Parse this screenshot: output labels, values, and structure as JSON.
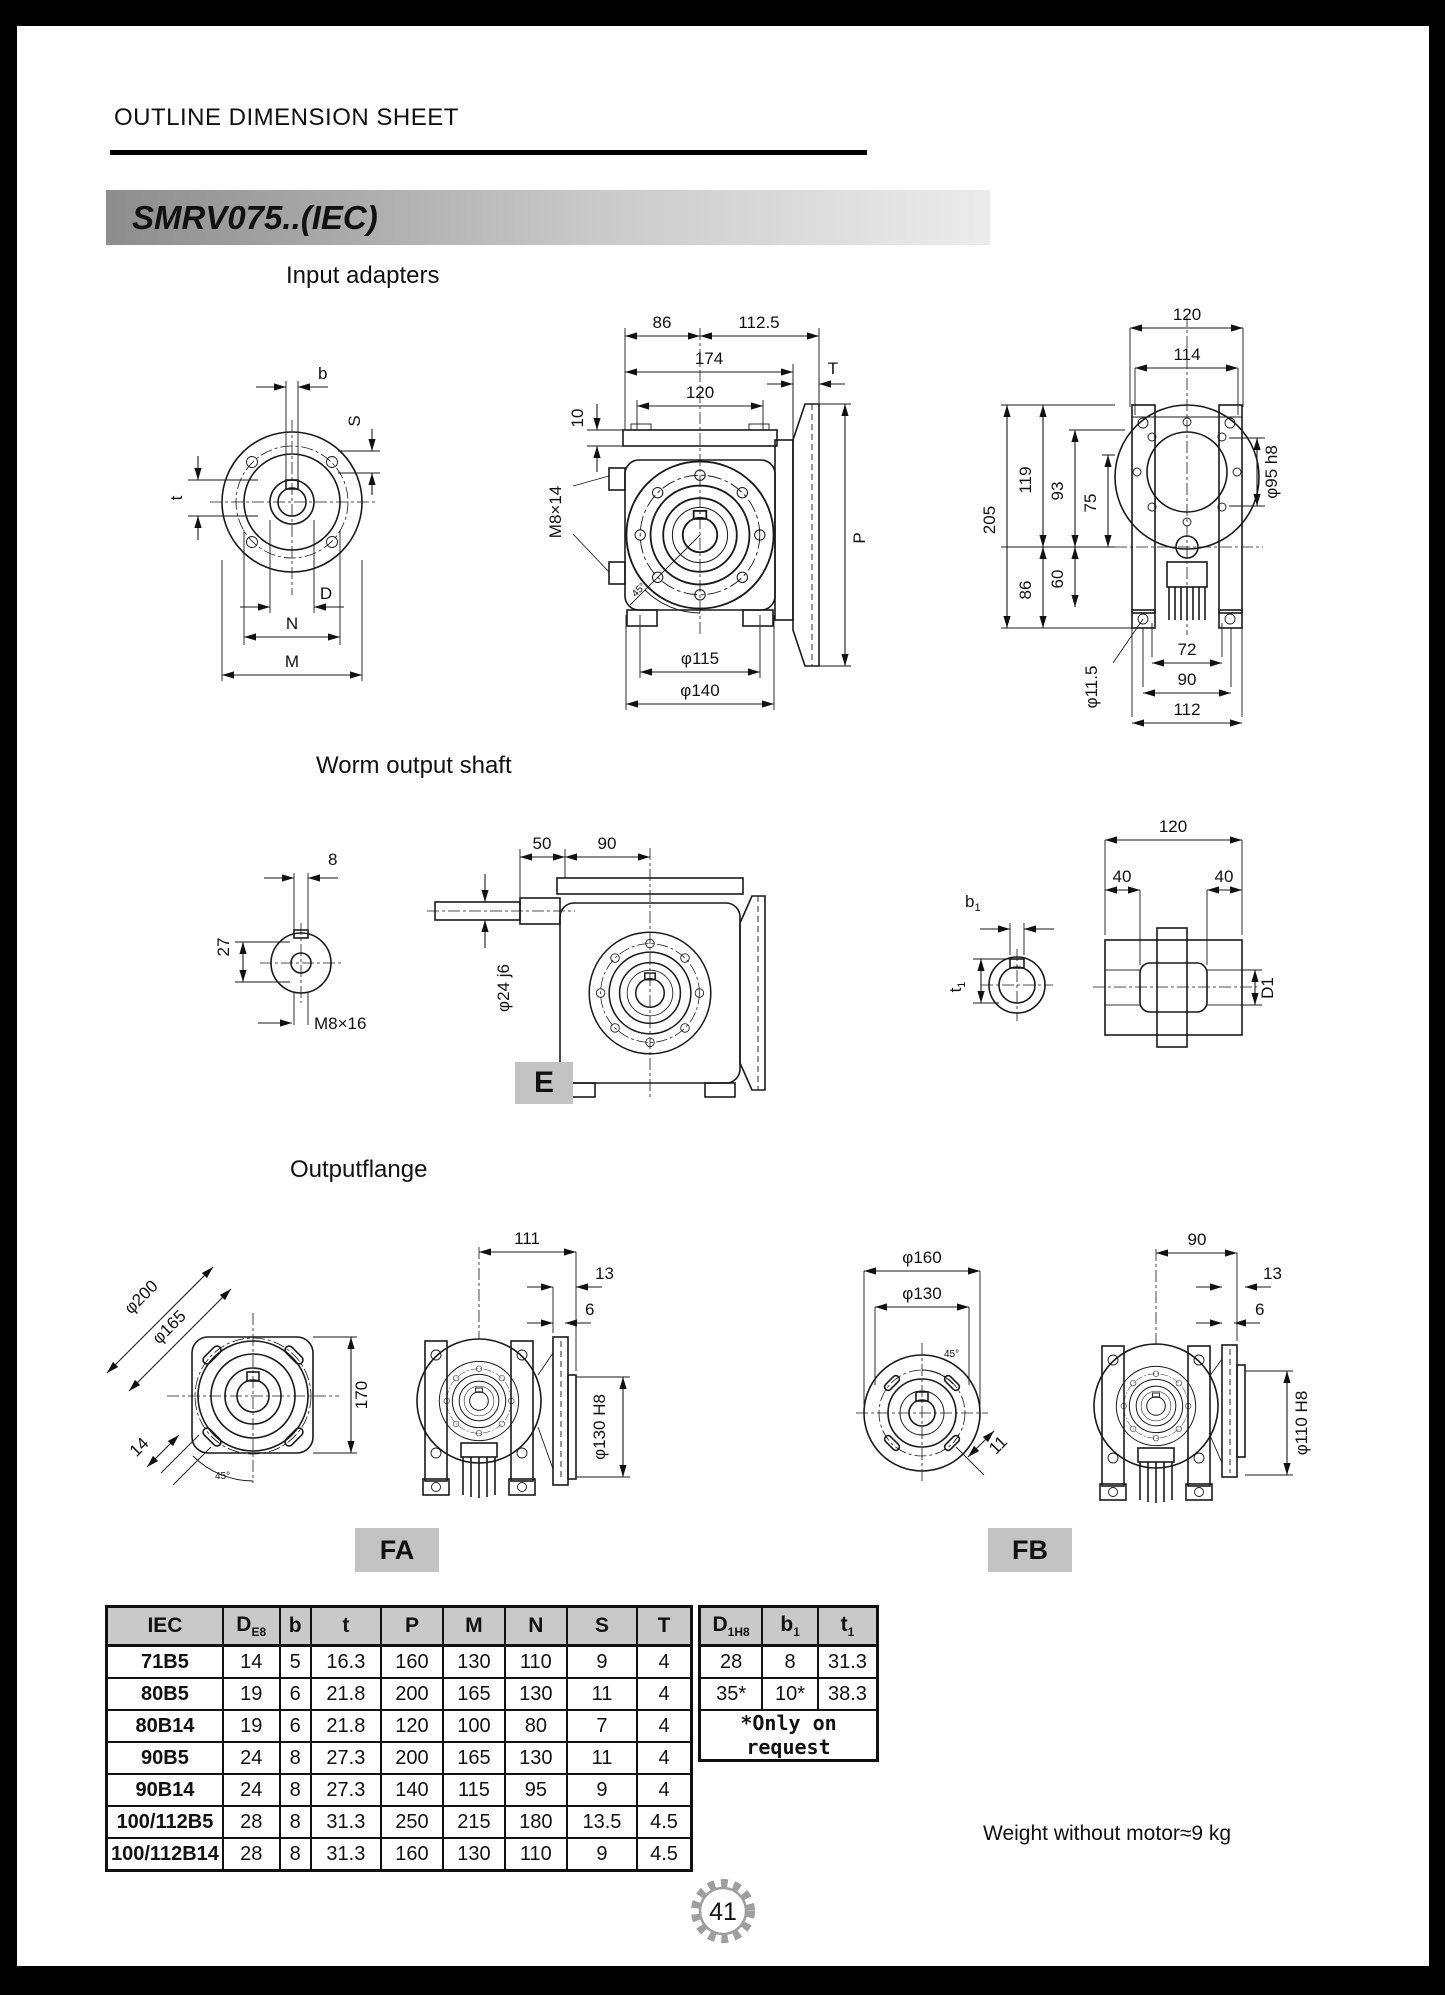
{
  "page": {
    "header_title": "OUTLINE DIMENSION SHEET",
    "model_title": "SMRV075..(IEC)",
    "weight_note": "Weight without motor≈9 kg",
    "page_number": "41"
  },
  "titles": {
    "input": "Input adapters",
    "worm": "Worm output shaft",
    "flange": "Outputflange"
  },
  "boxes": {
    "e": "E",
    "fa": "FA",
    "fb": "FB"
  },
  "ia_face": {
    "b": "b",
    "s": "S",
    "t": "t",
    "d": "D",
    "n": "N",
    "m": "M"
  },
  "ia_side": {
    "w86": "86",
    "w112_5": "112.5",
    "w174": "174",
    "w120": "120",
    "h10": "10",
    "tap": "M8×14",
    "t": "T",
    "p": "P",
    "d115": "φ115",
    "d140": "φ140",
    "ang": "45°"
  },
  "ia_rear": {
    "w120": "120",
    "w114": "114",
    "h205": "205",
    "h119": "119",
    "h93": "93",
    "h75": "75",
    "h86": "86",
    "h60": "60",
    "d95": "φ95 h8",
    "d11_5": "φ11.5",
    "w72": "72",
    "w90": "90",
    "w112": "112"
  },
  "wo_end": {
    "w8": "8",
    "h27": "27",
    "tap": "M8×16"
  },
  "wo_side": {
    "w50": "50",
    "w90": "90",
    "d24": "φ24 j6"
  },
  "wo_hollow": {
    "b1b": "b",
    "b1s": "1",
    "t1b": "t",
    "t1s": "1",
    "w120": "120",
    "w40l": "40",
    "w40r": "40",
    "d1": "D1"
  },
  "of_fa_face": {
    "d200": "φ200",
    "d165": "φ165",
    "h170": "170",
    "w14": "14",
    "ang": "45°"
  },
  "of_fa_side": {
    "w111": "111",
    "w13": "13",
    "w6": "6",
    "d130": "φ130 H8"
  },
  "of_fb_face": {
    "d160": "φ160",
    "d130": "φ130",
    "w11": "11",
    "ang": "45°"
  },
  "of_fb_side": {
    "w90": "90",
    "w13": "13",
    "w6": "6",
    "d110": "φ110 H8"
  },
  "table": {
    "left_headers": [
      {
        "b": "IEC"
      },
      {
        "b": "D",
        "s": "E8"
      },
      {
        "b": "b"
      },
      {
        "b": "t"
      },
      {
        "b": "P"
      },
      {
        "b": "M"
      },
      {
        "b": "N"
      },
      {
        "b": "S"
      },
      {
        "b": "T"
      }
    ],
    "right_headers": [
      {
        "b": "D",
        "s": "1H8"
      },
      {
        "b": "b",
        "s": "1"
      },
      {
        "b": "t",
        "s": "1"
      }
    ],
    "left_rows": [
      [
        "71B5",
        "14",
        "5",
        "16.3",
        "160",
        "130",
        "110",
        "9",
        "4"
      ],
      [
        "80B5",
        "19",
        "6",
        "21.8",
        "200",
        "165",
        "130",
        "11",
        "4"
      ],
      [
        "80B14",
        "19",
        "6",
        "21.8",
        "120",
        "100",
        "80",
        "7",
        "4"
      ],
      [
        "90B5",
        "24",
        "8",
        "27.3",
        "200",
        "165",
        "130",
        "11",
        "4"
      ],
      [
        "90B14",
        "24",
        "8",
        "27.3",
        "140",
        "115",
        "95",
        "9",
        "4"
      ],
      [
        "100/112B5",
        "28",
        "8",
        "31.3",
        "250",
        "215",
        "180",
        "13.5",
        "4.5"
      ],
      [
        "100/112B14",
        "28",
        "8",
        "31.3",
        "160",
        "130",
        "110",
        "9",
        "4.5"
      ]
    ],
    "right_rows": [
      [
        "28",
        "8",
        "31.3"
      ],
      [
        "35*",
        "10*",
        "38.3"
      ]
    ],
    "note": "*Only on request"
  },
  "colors": {
    "banner_dark": "#8d8d8d",
    "banner_light": "#ececec",
    "table_header_bg": "#c9c9c9",
    "gear_gray": "#9e9e9e",
    "box_gray": "#c3c3c3"
  }
}
